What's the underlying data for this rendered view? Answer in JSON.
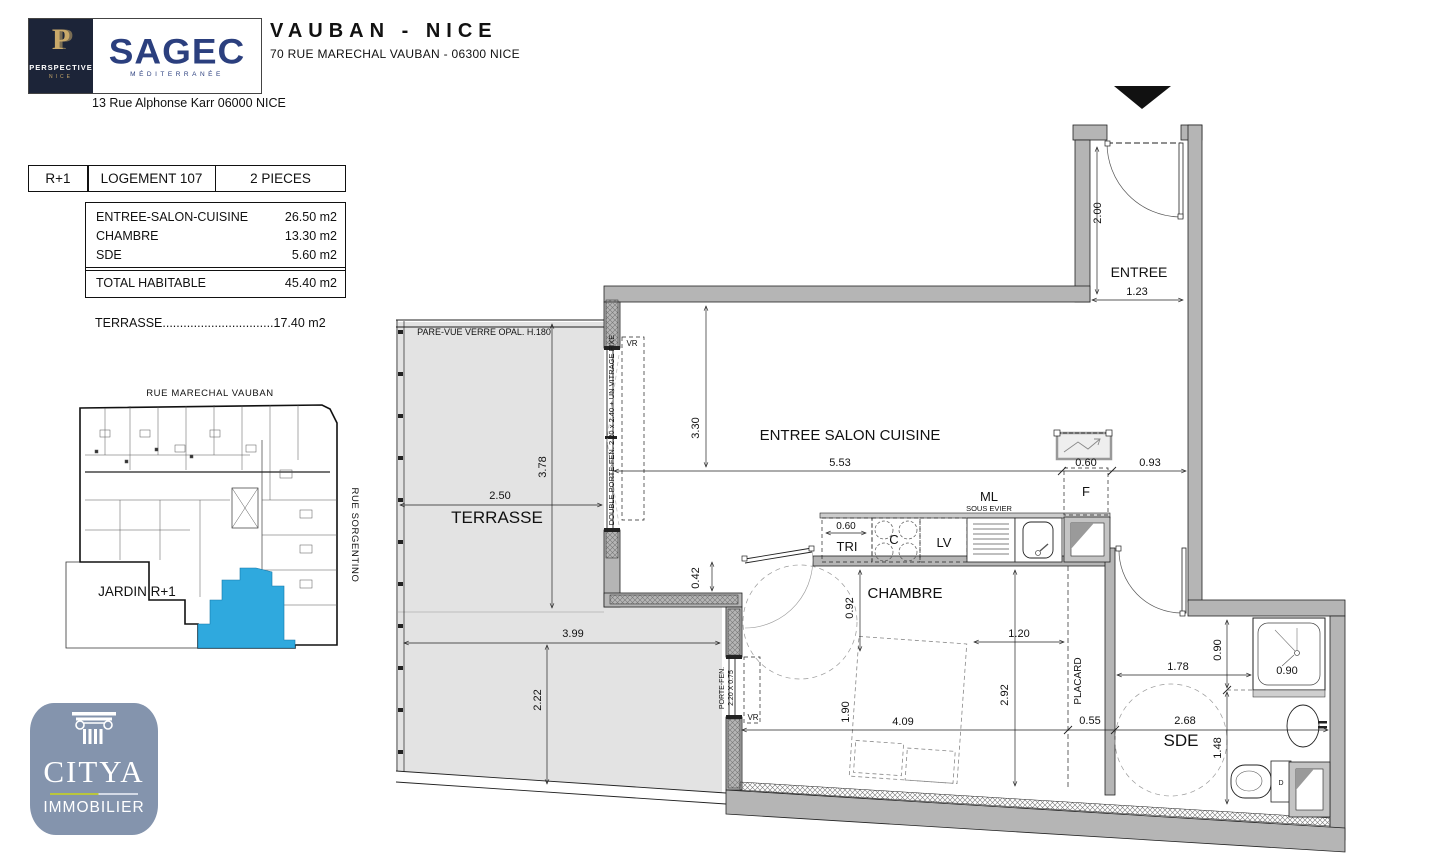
{
  "header": {
    "perspective": {
      "monogram": "P",
      "name": "PERSPECTIVE",
      "city": "NICE"
    },
    "sagec": {
      "name": "SAGEC",
      "tagline": "MÉDITERRANÉE"
    },
    "address": "13 Rue Alphonse Karr 06000 NICE",
    "title": "VAUBAN - NICE",
    "subtitle": "70 RUE MARECHAL VAUBAN - 06300 NICE"
  },
  "info": {
    "level": "R+1",
    "unit": "LOGEMENT 107",
    "type": "2 PIECES",
    "rows": [
      {
        "label": "ENTREE-SALON-CUISINE",
        "value": "26.50 m2"
      },
      {
        "label": "CHAMBRE",
        "value": "13.30 m2"
      },
      {
        "label": "SDE",
        "value": "5.60 m2"
      }
    ],
    "total_label": "TOTAL HABITABLE",
    "total_value": "45.40 m2",
    "terrace_label": "TERRASSE",
    "terrace_dots": "................................",
    "terrace_value": "17.40 m2"
  },
  "siteplan": {
    "street_top": "RUE MARECHAL VAUBAN",
    "street_right": "RUE SORGENTINO",
    "garden": "JARDIN R+1",
    "highlight_color": "#2fa9de"
  },
  "plan": {
    "rooms": {
      "entree": "ENTREE",
      "salon": "ENTREE SALON CUISINE",
      "chambre": "CHAMBRE",
      "terrasse": "TERRASSE",
      "sde": "SDE",
      "placard": "PLACARD"
    },
    "kitchen": {
      "tri": "TRI",
      "hob": "C",
      "lv": "LV",
      "ml": "ML",
      "sous_evier": "SOUS EVIER",
      "fridge": "F",
      "dim_tri": "0.60"
    },
    "labels": {
      "pare_vue": "PARE-VUE VERRE OPAL. H.180",
      "double_porte_fen": "DOUBLE PORTE-FEN. 2.20 x 2.40 + UN VITRAGE FIXE",
      "porte_fen_1": "PORTE-FEN.",
      "porte_fen_2": "2.20 X 0.75",
      "vr_salon": "VR",
      "vr_chambre": "VR",
      "d_wc": "D"
    },
    "dims": {
      "entree_h": "2.00",
      "entree_w": "1.23",
      "salon_h": "3.30",
      "salon_w": "5.53",
      "fridge_w": "0.60",
      "passage_w": "0.93",
      "corner": "0.42",
      "chambre_door": "0.92",
      "bed_side": "1.20",
      "chambre_h": "2.92",
      "placard_w": "0.55",
      "bed_len": "1.90",
      "chambre_w": "4.09",
      "terrasse_h1": "3.78",
      "terrasse_w1": "2.50",
      "terrasse_w2": "3.99",
      "terrasse_h2": "2.22",
      "shower_h": "0.90",
      "sde_w1": "1.78",
      "shower_w": "0.90",
      "sde_w2": "2.68",
      "sde_h": "1.48"
    }
  },
  "citya": {
    "name": "CITYA",
    "sub": "IMMOBILIER"
  }
}
